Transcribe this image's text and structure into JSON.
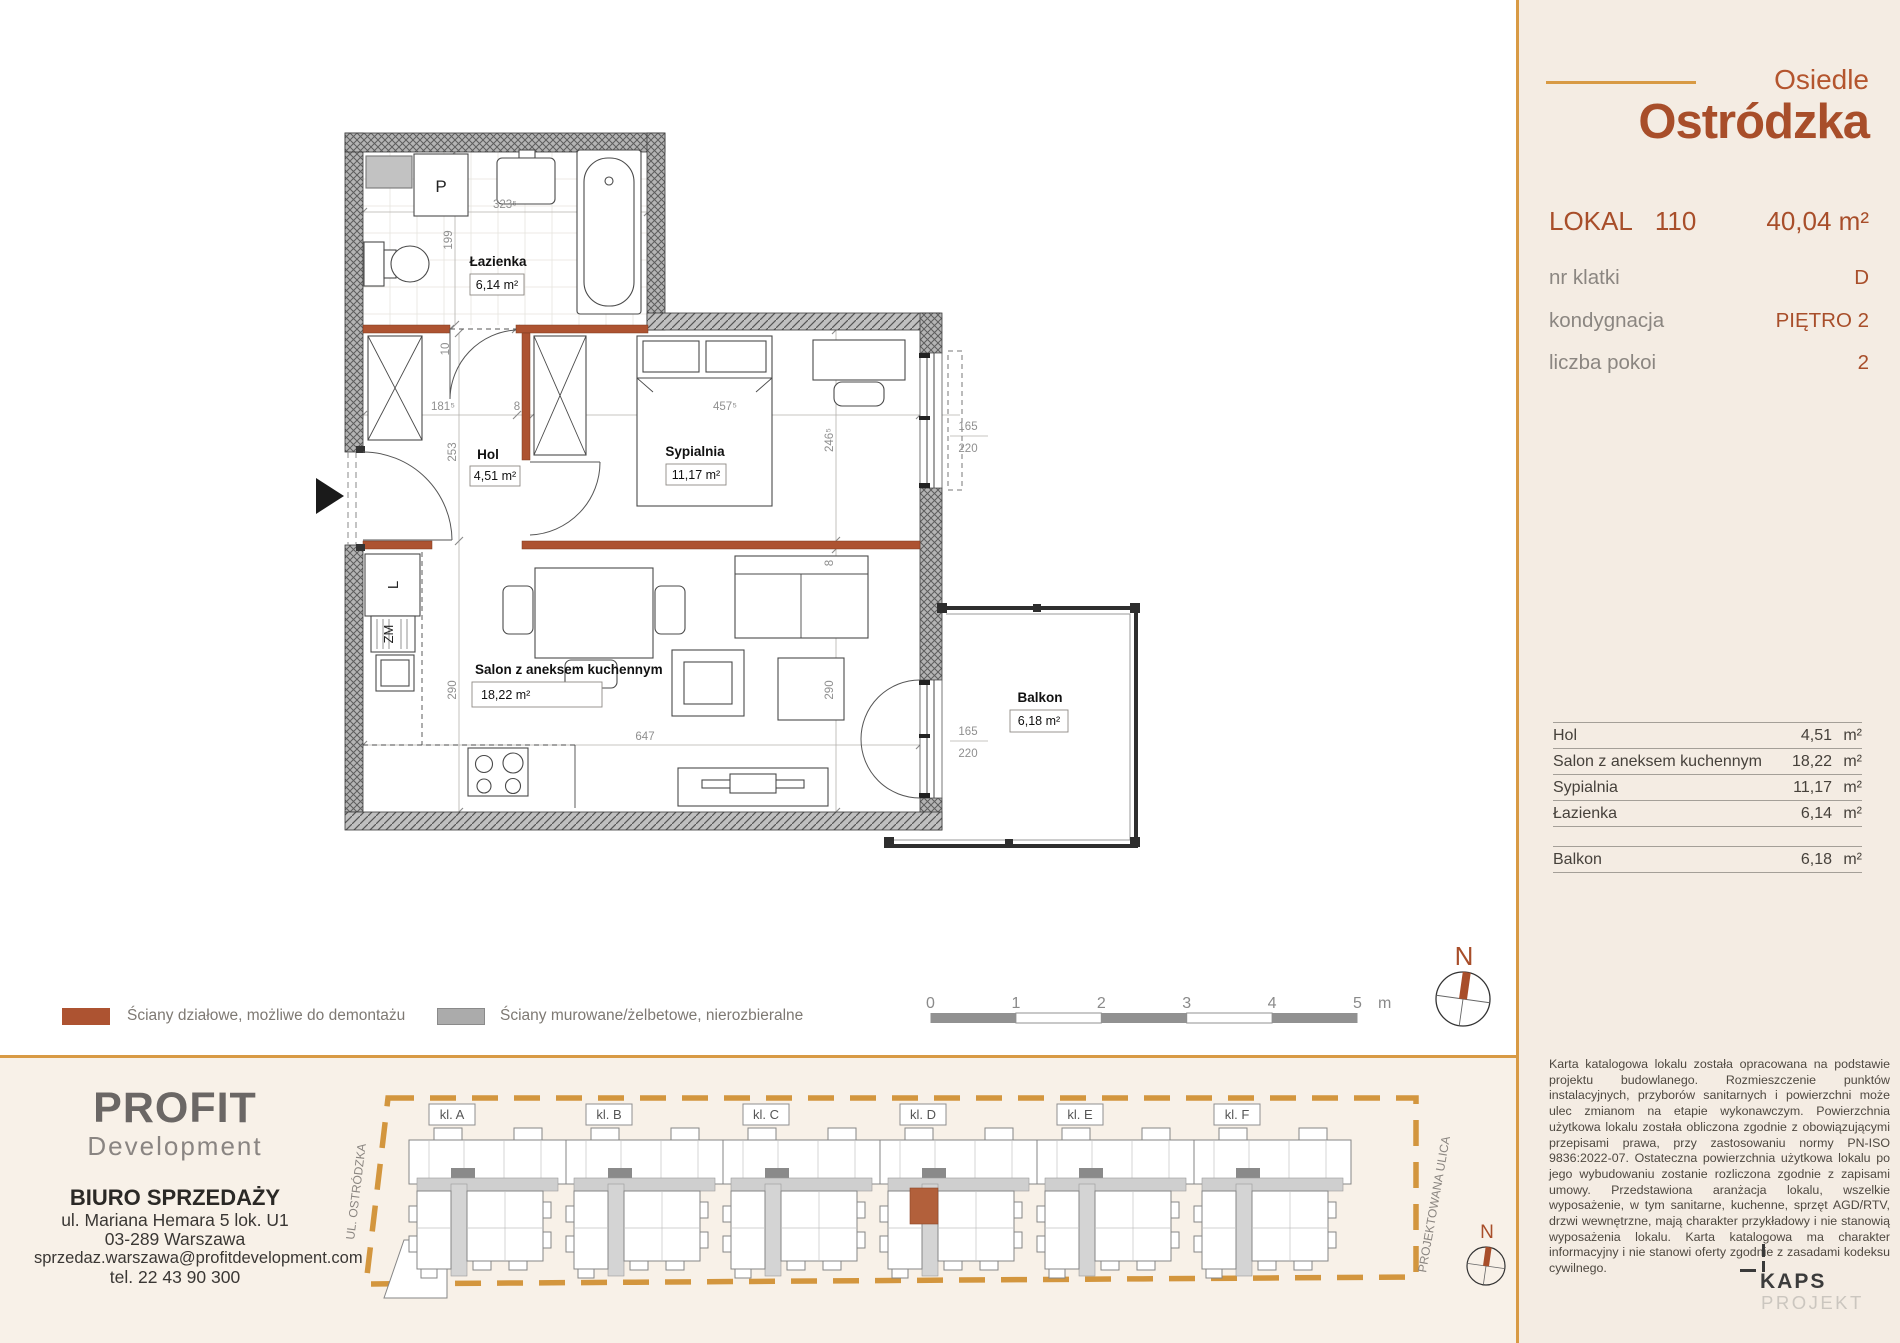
{
  "header": {
    "estate_prefix": "Osiedle",
    "estate_name": "Ostródzka",
    "lokal_label": "LOKAL",
    "lokal_number": "110",
    "total_area": "40,04  m²",
    "rows": [
      {
        "label": "nr klatki",
        "value": "D"
      },
      {
        "label": "kondygnacja",
        "value": "PIĘTRO 2"
      },
      {
        "label": "liczba pokoi",
        "value": "2"
      }
    ]
  },
  "room_table": {
    "rows": [
      {
        "name": "Hol",
        "area": "4,51",
        "unit": "m²"
      },
      {
        "name": "Salon z aneksem kuchennym",
        "area": "18,22",
        "unit": "m²"
      },
      {
        "name": "Sypialnia",
        "area": "11,17",
        "unit": "m²"
      },
      {
        "name": "Łazienka",
        "area": "6,14",
        "unit": "m²"
      }
    ],
    "balkon": {
      "name": "Balkon",
      "area": "6,18",
      "unit": "m²"
    }
  },
  "disclaimer": "Karta katalogowa lokalu została opracowana na podstawie projektu budowlanego. Rozmieszczenie punktów instalacyjnych, przyborów sanitarnych i powierzchni może ulec zmianom na etapie wykonawczym. Powierzchnia użytkowa lokalu została obliczona zgodnie z obowiązującymi przepisami prawa, przy zastosowaniu normy PN-ISO 9836:2022-07. Ostateczna powierzchnia użytkowa lokalu po jego wybudowaniu zostanie rozliczona zgodnie z zapisami umowy. Przedstawiona aranżacja lokalu, wszelkie wyposażenie, w tym sanitarne, kuchenne, sprzęt AGD/RTV, drzwi wewnętrzne, mają charakter przykładowy i nie stanowią wyposażenia lokalu. Karta katalogowa ma charakter informacyjny i nie stanowi oferty zgodnie z zasadami kodeksu cywilnego.",
  "plan": {
    "rooms": {
      "lazienka": {
        "name": "Łazienka",
        "area": "6,14 m²"
      },
      "hol": {
        "name": "Hol",
        "area": "4,51 m²"
      },
      "sypialnia": {
        "name": "Sypialnia",
        "area": "11,17 m²"
      },
      "salon": {
        "name": "Salon z aneksem kuchennym",
        "area": "18,22 m²"
      },
      "balkon": {
        "name": "Balkon",
        "area": "6,18 m²"
      }
    },
    "appliances": {
      "washer": "P",
      "fridge": "L",
      "sink": "ZM"
    },
    "dims": {
      "bath_w": "323⁵",
      "bath_h": "199",
      "bath_door": "10",
      "hol_w": "181⁵",
      "wall_a": "8",
      "bed_w": "457⁵",
      "hol_h": "253",
      "bed_h": "246⁵",
      "win_w": "165",
      "win_h": "220",
      "salon_h_left": "290",
      "salon_h_right": "290",
      "salon_w": "647",
      "wall_b": "8",
      "baldoor_w": "165",
      "baldoor_h": "220"
    }
  },
  "legend": {
    "items": [
      {
        "label": "Ściany działowe, możliwe do demontażu",
        "color": "#ad5331"
      },
      {
        "label": "Ściany murowane/żelbetowe, nierozbieralne",
        "color": "#ababab"
      }
    ]
  },
  "scalebar": {
    "ticks": [
      "0",
      "1",
      "2",
      "3",
      "4",
      "5"
    ],
    "unit": "m"
  },
  "compass": {
    "label": "N"
  },
  "seller": {
    "brand": "PROFIT",
    "brand_sub": "Development",
    "office": "BIURO SPRZEDAŻY",
    "address1": "ul. Mariana Hemara 5 lok. U1",
    "address2": "03-289 Warszawa",
    "email": "sprzedaz.warszawa@profitdevelopment.com",
    "phone": "tel. 22 43 90 300"
  },
  "siteplan": {
    "street_left": "UL. OSTRÓDZKA",
    "street_right": "PROJEKTOWANA ULICA",
    "sections": [
      "kl. A",
      "kl. B",
      "kl. C",
      "kl. D",
      "kl. E",
      "kl. F"
    ]
  },
  "kaps": {
    "name": "KAPS",
    "sub": "PROJEKT"
  },
  "colors": {
    "accent_rust": "#a84e2a",
    "accent_orange": "#d89a44",
    "partition_wall": "#ad5331",
    "masonry_wall": "#9b9b9b",
    "highlight_unit": "#b2603b"
  }
}
